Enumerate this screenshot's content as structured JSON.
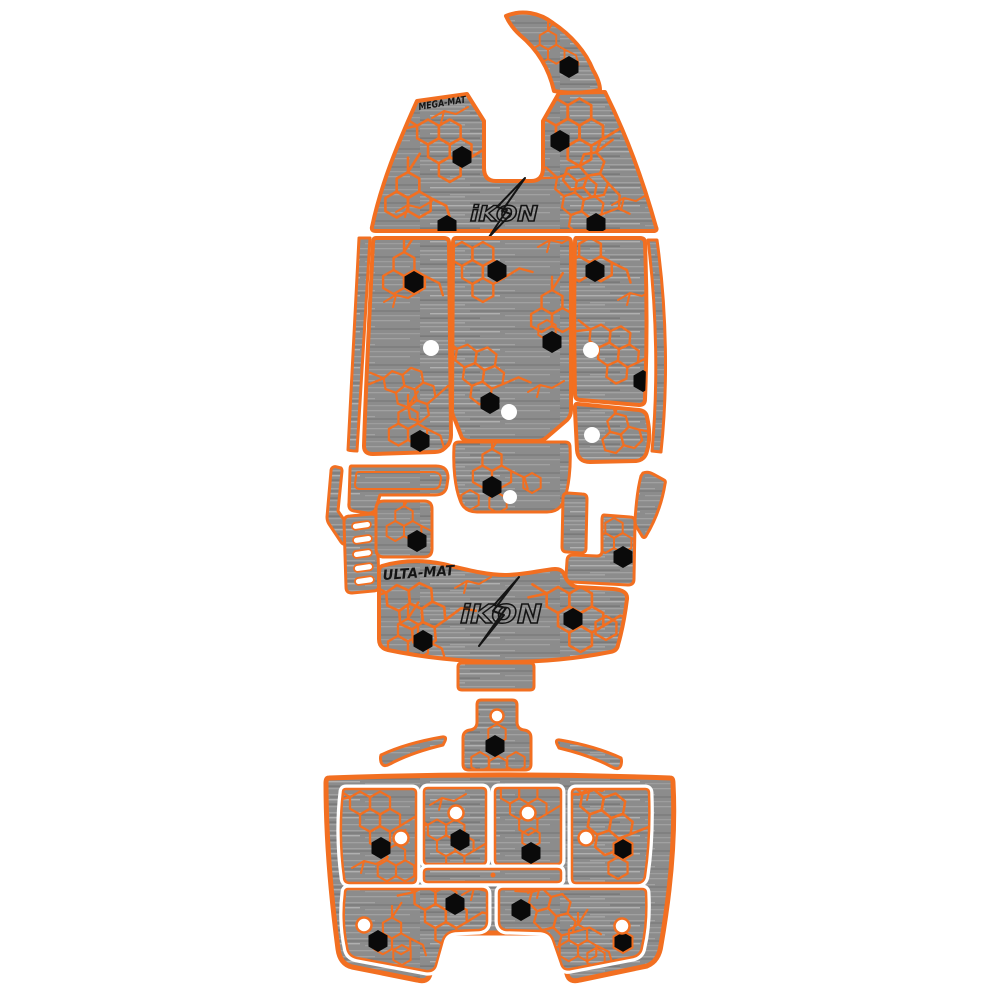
{
  "labels": {
    "mega_mat": "MEGA-MAT",
    "ulta_mat": "ULTA-MAT",
    "logo_bow": "iKON",
    "logo_main": "iKON"
  },
  "colors": {
    "orange": "#F26F21",
    "mat_gray": "#8C8C8C",
    "streak_light": "#A3A3A3",
    "streak_lighter": "#B9B9B9",
    "streak_dark": "#6F6F6F",
    "detail_black": "#0A0A0A",
    "logo_black": "#141414",
    "hole_white": "#FFFFFF",
    "background": "#FFFFFF"
  },
  "pieces": [
    "bow-tip",
    "bow-main",
    "cockpit-left-edge-trim",
    "cockpit-left-panel",
    "cockpit-center-panel",
    "cockpit-right-panel",
    "cockpit-right-lower-panel",
    "cockpit-right-edge-trim",
    "step-pad",
    "side-trim",
    "ladder-pad",
    "small-square-pad",
    "console-pad",
    "side-strip",
    "boot-pad",
    "blade-trim",
    "mid-deck-main",
    "small-rectangle-pad",
    "transom-plug-pad",
    "wing-trim-left",
    "wing-trim-right",
    "rear-platform"
  ]
}
